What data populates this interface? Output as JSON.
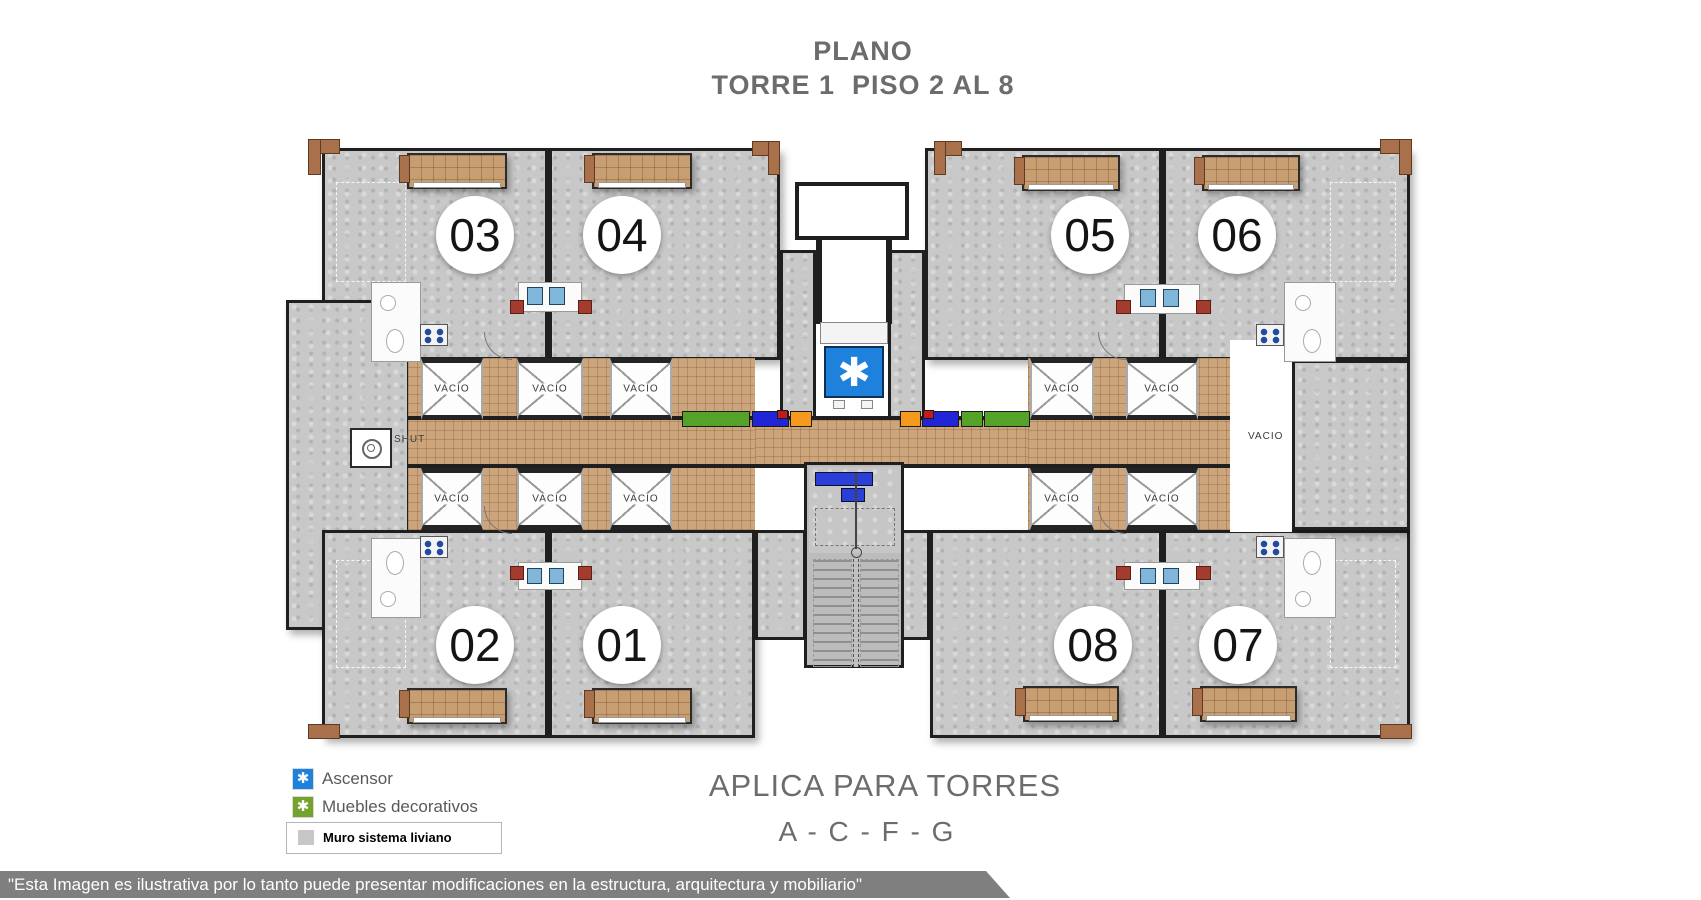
{
  "title": {
    "line1": "PLANO",
    "line2": "TORRE 1  PISO 2 AL 8"
  },
  "plan": {
    "elevator_symbol": "✱",
    "vacio_label": "VACIO",
    "units": [
      {
        "number": "03",
        "cx": 475,
        "cy": 235
      },
      {
        "number": "04",
        "cx": 622,
        "cy": 235
      },
      {
        "number": "05",
        "cx": 1090,
        "cy": 235
      },
      {
        "number": "06",
        "cx": 1237,
        "cy": 235
      },
      {
        "number": "02",
        "cx": 475,
        "cy": 645
      },
      {
        "number": "01",
        "cx": 622,
        "cy": 645
      },
      {
        "number": "08",
        "cx": 1093,
        "cy": 645
      },
      {
        "number": "07",
        "cx": 1238,
        "cy": 645
      }
    ],
    "wells": [
      {
        "x": 421,
        "y": 358,
        "w": 62,
        "h": 62
      },
      {
        "x": 517,
        "y": 358,
        "w": 66,
        "h": 62
      },
      {
        "x": 610,
        "y": 358,
        "w": 62,
        "h": 62
      },
      {
        "x": 1030,
        "y": 358,
        "w": 64,
        "h": 62
      },
      {
        "x": 1126,
        "y": 358,
        "w": 72,
        "h": 62
      },
      {
        "x": 421,
        "y": 468,
        "w": 62,
        "h": 62
      },
      {
        "x": 517,
        "y": 468,
        "w": 66,
        "h": 62
      },
      {
        "x": 610,
        "y": 468,
        "w": 62,
        "h": 62
      },
      {
        "x": 1030,
        "y": 468,
        "w": 64,
        "h": 62
      },
      {
        "x": 1126,
        "y": 468,
        "w": 72,
        "h": 62
      }
    ],
    "extra_labels": [
      {
        "text": "VACIO",
        "x": 1248,
        "y": 431
      },
      {
        "text": "SHUT",
        "x": 394,
        "y": 434
      }
    ]
  },
  "legend": {
    "symbol": "✱",
    "items": [
      {
        "label": "Ascensor",
        "color": "#1e82dd"
      },
      {
        "label": "Muebles decorativos",
        "color": "#74a32d"
      }
    ],
    "wall": {
      "label": "Muro sistema liviano",
      "swatch": "#c7c7c7"
    }
  },
  "footer": {
    "applies_line1": "APLICA PARA TORRES",
    "applies_line2": "A - C - F - G",
    "disclaimer": "\"Esta Imagen es ilustrativa por lo tanto puede presentar modificaciones en la estructura, arquitectura y mobiliario\""
  },
  "colors": {
    "wall_dark": "#1f1f1f",
    "title_gray": "#6c6c6c",
    "banner_gray": "#7f7f7f",
    "elevator_blue": "#1e82dd",
    "legend_green": "#74a32d",
    "tile": "#cda57c",
    "furniture_orange": "#f59a1c",
    "furniture_blue": "#2026d6",
    "furniture_green": "#55a228",
    "furniture_red": "#c41a1a"
  }
}
